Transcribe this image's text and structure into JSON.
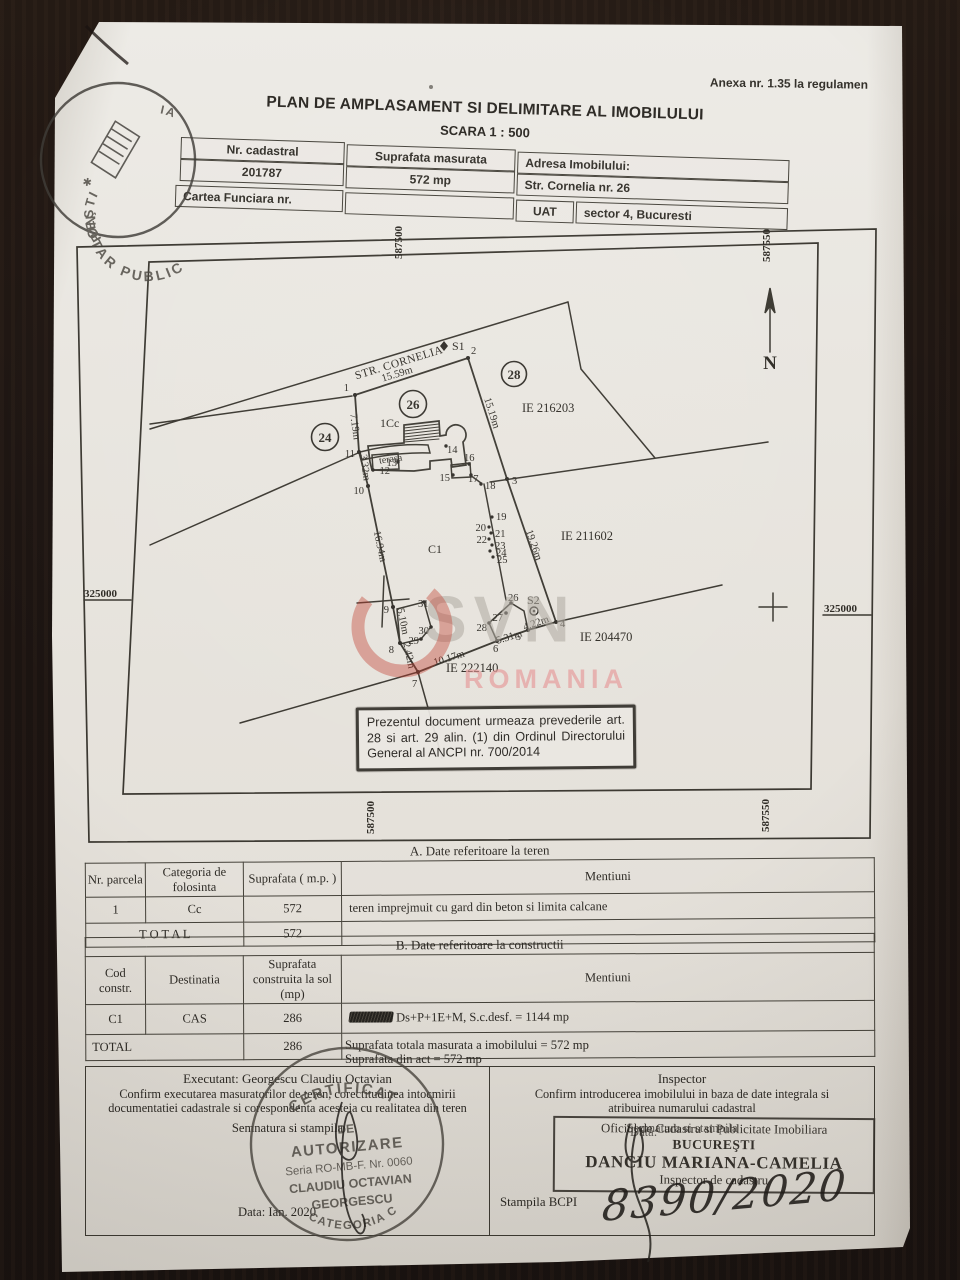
{
  "page": {
    "annex": "Anexa nr. 1.35 la regulamen",
    "title": "PLAN DE AMPLASAMENT SI DELIMITARE AL IMOBILULUI",
    "scale": "SCARA 1 : 500"
  },
  "header_table": {
    "nr_cadastral_label": "Nr. cadastral",
    "nr_cadastral_value": "201787",
    "suprafata_label": "Suprafata masurata",
    "suprafata_value": "572 mp",
    "adresa_label": "Adresa Imobilului:",
    "adresa_value": "Str. Cornelia nr. 26",
    "cartea_funciara_label": "Cartea Funciara nr.",
    "uat_label": "UAT",
    "uat_value": "sector 4, Bucuresti"
  },
  "plan": {
    "grid": {
      "top_left": "587500",
      "top_right": "587550",
      "bottom_left": "587500",
      "bottom_right": "587550",
      "left": "325000",
      "right": "325000"
    },
    "north_label": "N",
    "street": "STR. CORNELIA",
    "station1": "S1",
    "station2": "S2",
    "parcel_circles": [
      "24",
      "26",
      "28"
    ],
    "land_use": "1Cc",
    "building_code": "C1",
    "terrace": "terasa",
    "ie_labels": [
      "IE 216203",
      "IE 211602",
      "IE 204470",
      "IE 222140"
    ],
    "measurements": [
      "15.59m",
      "7.19m",
      "3.32m",
      "16.94m",
      "5.10m",
      "2.42m",
      "10.17m",
      "5.31m",
      "4.22m",
      "15.19m",
      "19.26m"
    ],
    "point_labels": [
      "1",
      "2",
      "3",
      "4",
      "5",
      "6",
      "7",
      "8",
      "9",
      "10",
      "11",
      "12",
      "13",
      "14",
      "15",
      "16",
      "17",
      "18",
      "19",
      "20",
      "21",
      "22",
      "23",
      "24",
      "25",
      "26",
      "27",
      "28",
      "29",
      "30",
      "31"
    ],
    "note": "Prezentul document urmeaza prevederile art. 28 si art. 29 alin. (1) din Ordinul Directorului General al ANCPI nr. 700/2014"
  },
  "table_a": {
    "title": "A. Date referitoare la teren",
    "headers": [
      "Nr. parcela",
      "Categoria de folosinta",
      "Suprafata ( m.p. )",
      "Mentiuni"
    ],
    "row": [
      "1",
      "Cc",
      "572",
      "teren imprejmuit cu gard din beton si limita calcane"
    ],
    "total_label": "T O T A L",
    "total_value": "572"
  },
  "table_b": {
    "title": "B. Date referitoare la constructii",
    "headers": [
      "Cod constr.",
      "Destinatia",
      "Suprafata construita la sol (mp)",
      "Mentiuni"
    ],
    "row": [
      "C1",
      "CAS",
      "286",
      "Ds+P+1E+M, S.c.desf. = 1144 mp"
    ],
    "total_label": "TOTAL",
    "total_value": "286"
  },
  "summary": {
    "line1": "Suprafata totala masurata a imobilului = 572 mp",
    "line2": "Suprafata din act = 572 mp"
  },
  "footer": {
    "left": {
      "executant": "Executant: Georgescu Claudiu Octavian",
      "confirm": "Confirm executarea masuratorilor de teren, corectitudinea intocmirii documentatiei cadastrale si corespondenta acesteia cu realitatea din teren",
      "signature_label": "Semnatura si stampila",
      "date": "Data: Ian. 2020",
      "stamp": {
        "line1": "CERTIFICAT",
        "line2": "DE",
        "line3": "AUTORIZARE",
        "seria": "Seria RO-MB-F. Nr. 0060",
        "name1": "CLAUDIU OCTAVIAN",
        "name2": "GEORGESCU",
        "categoria": "CATEGORIA C"
      }
    },
    "right": {
      "inspector": "Inspector",
      "confirm": "Confirm introducerea imobilului in baza de date integrala si atribuirea numarului cadastral",
      "signature_label": "Semnatura si stampila",
      "date_label": "Data:",
      "stamp": {
        "office_line1": "Oficiul de Cadastru si Publicitate Imobiliara",
        "office_line2": "BUCUREŞTI",
        "name": "DANCIU MARIANA-CAMELIA",
        "role": "Inspector de cadastru"
      },
      "stampila_label": "Stampila BCPI",
      "handwritten_number": "8390/2020"
    }
  },
  "notary_stamp": {
    "ring_text": "NOTAR PUBLIC",
    "city_fragment": "REŞTI",
    "top_fragment": "IA"
  },
  "watermark": {
    "logo": "SVN",
    "text": "ROMANIA"
  },
  "colors": {
    "paper": "#e7e4de",
    "ink": "#2e2b26",
    "stamp_ink": "#45423c",
    "watermark_red": "#c0392b",
    "watermark_pink": "#e79c9c"
  }
}
